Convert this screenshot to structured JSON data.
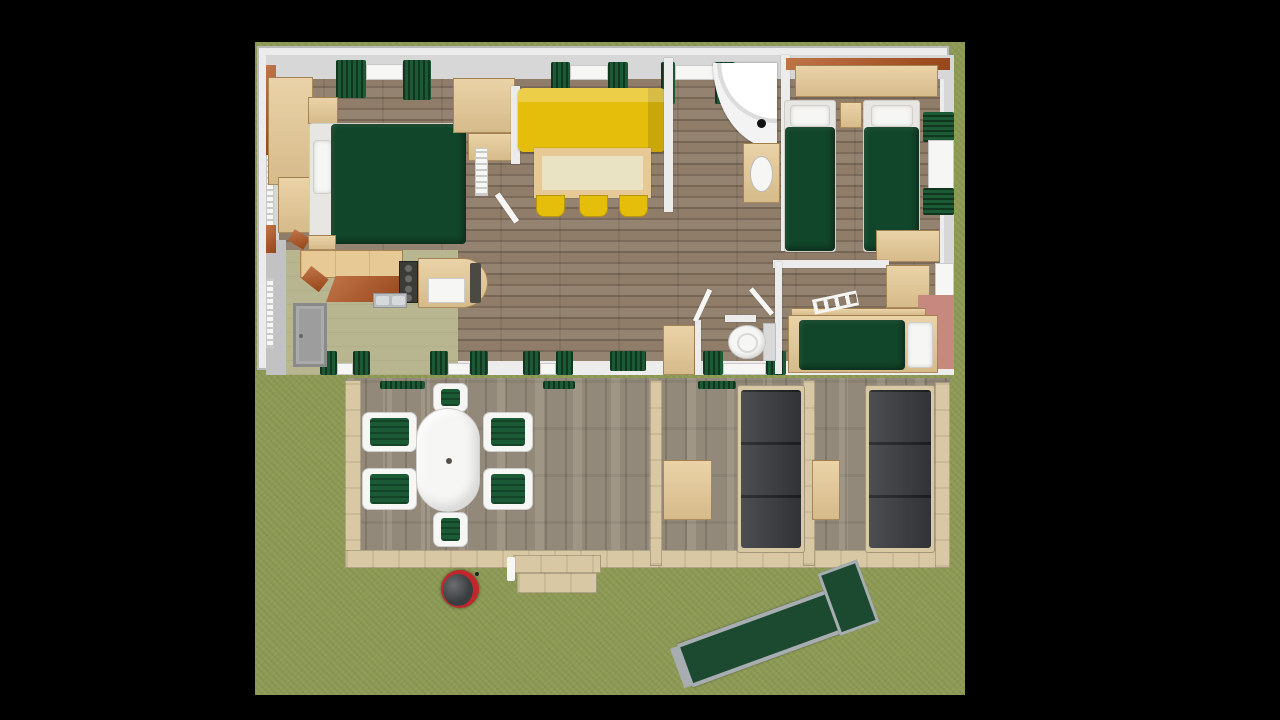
{
  "scene": {
    "title": "top-down-3d-render-of-holiday-mobile-home",
    "description": "Orthographic top-down 3D render of a furnished two/three-bedroom mobile home (chalet) with a wooden terrace, outdoor dining set, two lounge corners, barbecue, entry steps, wheelchair access ramp and surrounding lawn. Image is letterboxed with black bars.",
    "view": "top-down",
    "visible_text": "none",
    "rooms": [
      {
        "name": "master-bedroom",
        "furniture": [
          "double bed with dark green cover",
          "white pillows",
          "wardrobe",
          "desk",
          "nightstand",
          "corner desk",
          "bench",
          "vertical radiator"
        ]
      },
      {
        "name": "living-dining",
        "furniture": [
          "yellow sofa",
          "dining table with cream top",
          "three yellow stools"
        ]
      },
      {
        "name": "kitchen",
        "furniture": [
          "worktop",
          "hob",
          "double sink",
          "orange cabinet fronts",
          "counter with fridge and rounded end",
          "grey entry door"
        ]
      },
      {
        "name": "shower-room",
        "furniture": [
          "corner quarter-circle shower",
          "washbasin vanity"
        ]
      },
      {
        "name": "wc",
        "furniture": [
          "toilet",
          "storage console",
          "open doors"
        ]
      },
      {
        "name": "twin-bedroom",
        "furniture": [
          "two single beds with dark green covers",
          "nightstand",
          "wall shelf with orange back rail",
          "desk",
          "window with green curtains"
        ]
      },
      {
        "name": "kids-bedroom",
        "furniture": [
          "bunk bed with ladder",
          "pink bed frame",
          "wardrobe",
          "window"
        ]
      },
      {
        "name": "terrace",
        "furniture": [
          "oval white dining table",
          "six chairs with green cushions",
          "two grey lounge sofas",
          "two coffee tables",
          "wood railing dividers",
          "entry steps"
        ]
      },
      {
        "name": "garden",
        "furniture": [
          "red kettle barbecue",
          "green access ramp with grey rails",
          "lawn"
        ]
      }
    ],
    "counts": {
      "terrace_chairs": 6,
      "stools": 3,
      "single_beds": 3,
      "double_beds": 1,
      "lounge_sofas": 2,
      "top_wall_windows": 3,
      "bottom_wall_windows": 5,
      "right_wall_windows": 2
    }
  },
  "colors": {
    "black": "#000000",
    "grass": "#8e9b55",
    "deck": "#9a9080",
    "wood-frame": "#d8c9a4",
    "wood-furn": "#e6c995",
    "orange": "#b0521c",
    "wall": "#ececec",
    "wall-face": "#d7d7d7",
    "floor": "#8d7a66",
    "khaki": "#b8b591",
    "bed-green": "#12462a",
    "curtain": "#1b5a35",
    "yellow": "#e5bd0b",
    "cream": "#eae3c3",
    "white": "#f6f6f4",
    "sofa-gray": "#3e4144",
    "pink": "#c7887f",
    "bbq-red": "#c1272d",
    "lid-gray": "#3a3d40",
    "ramp-green": "#1c4a31",
    "rail-gray": "#a7adb0",
    "door-gray": "#9d9d9d",
    "stove": "#3b3b38",
    "gray-floor": "#c2c2c2"
  }
}
